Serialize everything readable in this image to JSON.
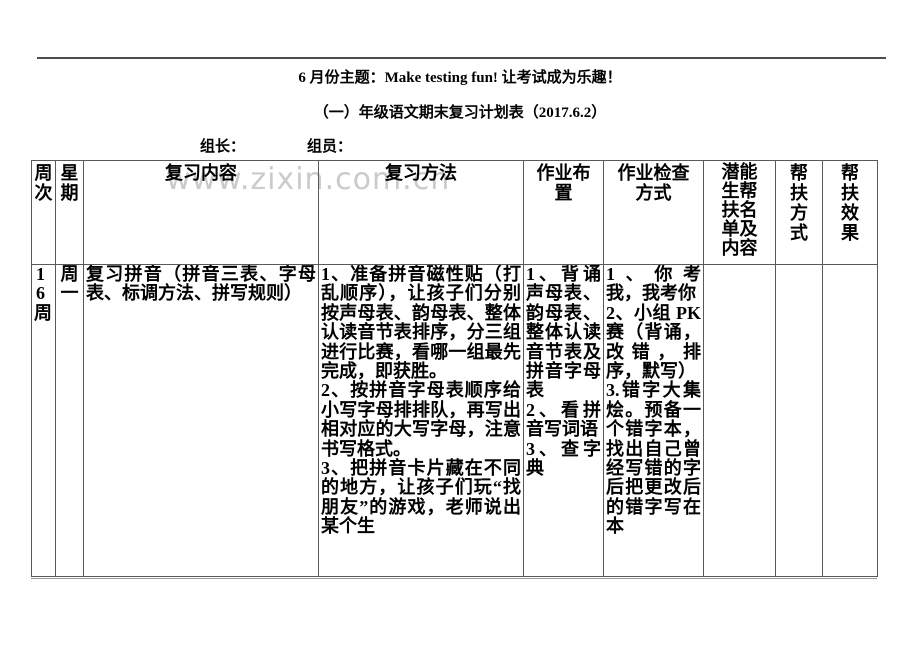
{
  "page": {
    "title_line1": "6 月份主题：Make testing fun! 让考试成为乐趣！",
    "title_line2": "（一）年级语文期末复习计划表（2017.6.2）",
    "group_leader_label": "组长：",
    "group_member_label": "组员：",
    "watermark_text": "www.zixin.com.cn"
  },
  "table": {
    "headers": {
      "week": "周次",
      "day": "星期",
      "review_content": "复习内容",
      "review_method": "复习方法",
      "homework": "作业布置",
      "homework_check": "作业检查方式",
      "potential_students": "潜能生帮扶名单及内容",
      "help_method": "帮扶方式",
      "help_effect": "帮扶效果"
    },
    "row": {
      "week": "16周",
      "day": "周一",
      "review_content": "复习拼音（拼音三表、字母表、标调方法、拼写规则）",
      "review_method": [
        "1、准备拼音磁性贴（打乱顺序），让孩子们分别按声母表、韵母表、整体认读音节表排序，分三组进行比赛，看哪一组最先完成，即获胜。",
        "2、按拼音字母表顺序给小写字母排排队，再写出相对应的大写字母，注意书写格式。",
        "3、把拼音卡片藏在不同的地方，让孩子们玩“找朋友”的游戏，老师说出某个生"
      ],
      "homework": [
        "1、背诵声母表、韵母表、整体认读音节表及拼音字母表",
        "2、看拼音写词语",
        "3、查字典"
      ],
      "homework_check": [
        "1、你考我，我考你",
        "2、小组 PK 赛（背诵，改错，排序，默写）",
        "3.错字大集烩。预备一个错字本，找出自己曾经写错的字后把更改后的错字写在本"
      ],
      "potential_students": "",
      "help_method": "",
      "help_effect": ""
    }
  }
}
